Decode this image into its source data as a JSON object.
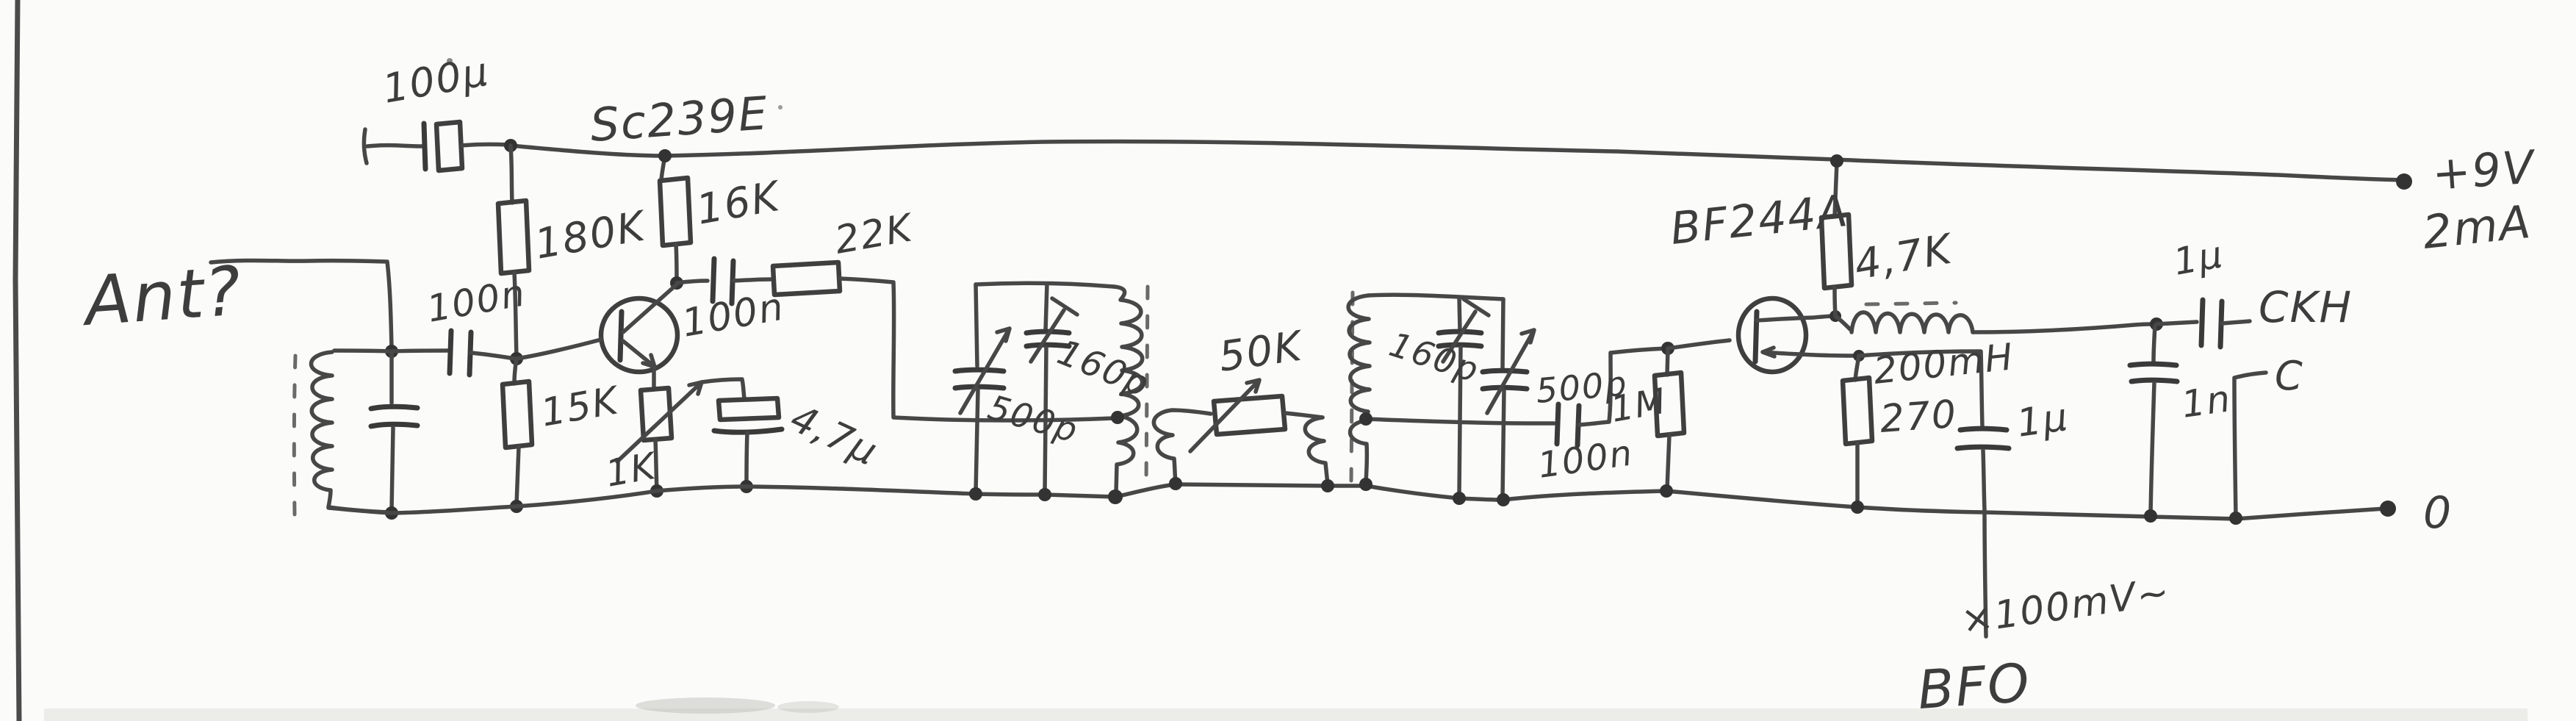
{
  "labels": {
    "ant": "Ant?",
    "c100u": "100μ",
    "q1": "Sc239E",
    "r180k": "180K",
    "r16k": "16K",
    "r22k": "22K",
    "c100n_a": "100n",
    "c100n_b": "100n",
    "r15k": "15K",
    "r1k": "1K",
    "c4u7": "4,7μ",
    "c500p_1": "500p",
    "c160p_1": "160p",
    "pot50k": "50K",
    "c160p_2": "160p",
    "c500p_2": "500p",
    "c100n_c": "100n",
    "r1m": "1M",
    "q2": "BF244A",
    "r4k7": "4,7K",
    "l200mh": "200mH",
    "r270": "270",
    "c1u_bfo": "1μ",
    "c1u_out": "1μ",
    "c1n": "1n",
    "out_ckh": "CKH",
    "out_c": "C",
    "rail_pos": "+9V",
    "rail_cur": "2mA",
    "rail_gnd": "0",
    "bfo_level": "×100mV~",
    "bfo": "BFO"
  },
  "colors": {
    "pencil": "#474747",
    "paper": "#fbfbfa"
  }
}
